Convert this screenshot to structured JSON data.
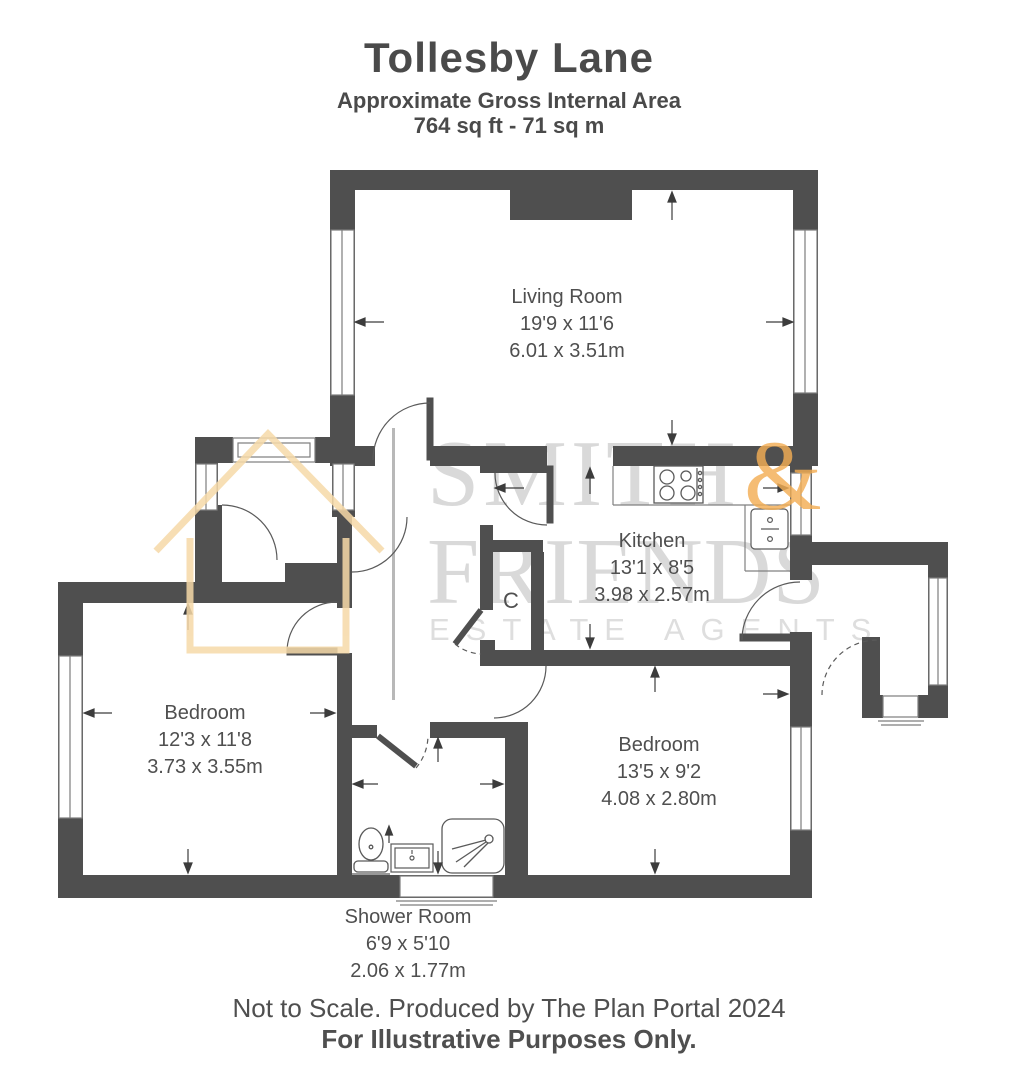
{
  "header": {
    "title": "Tollesby Lane",
    "subtitle": "Approximate Gross Internal Area",
    "area": "764 sq ft - 71 sq m"
  },
  "rooms": {
    "living_room": {
      "name": "Living Room",
      "imperial": "19'9 x 11'6",
      "metric": "6.01 x 3.51m"
    },
    "kitchen": {
      "name": "Kitchen",
      "imperial": "13'1 x 8'5",
      "metric": "3.98 x 2.57m"
    },
    "bedroom_left": {
      "name": "Bedroom",
      "imperial": "12'3 x 11'8",
      "metric": "3.73 x 3.55m"
    },
    "bedroom_right": {
      "name": "Bedroom",
      "imperial": "13'5 x 9'2",
      "metric": "4.08 x 2.80m"
    },
    "shower_room": {
      "name": "Shower Room",
      "imperial": "6'9 x 5'10",
      "metric": "2.06 x 1.77m"
    },
    "cupboard": {
      "label": "C"
    }
  },
  "watermark": {
    "brand_word1": "SMITH",
    "ampersand": "&",
    "brand_word2": "FRIENDS",
    "brand_tagline": "ESTATE AGENTS"
  },
  "footer": {
    "line1": "Not to Scale. Produced by The Plan Portal 2024",
    "line2": "For Illustrative Purposes Only."
  },
  "colors": {
    "wall": "#4f4f4f",
    "label_text": "#4f4f4f",
    "watermark_gray": "#d9d9d9",
    "watermark_orange": "#f3ae55",
    "house_outline": "#f6d9a8"
  }
}
